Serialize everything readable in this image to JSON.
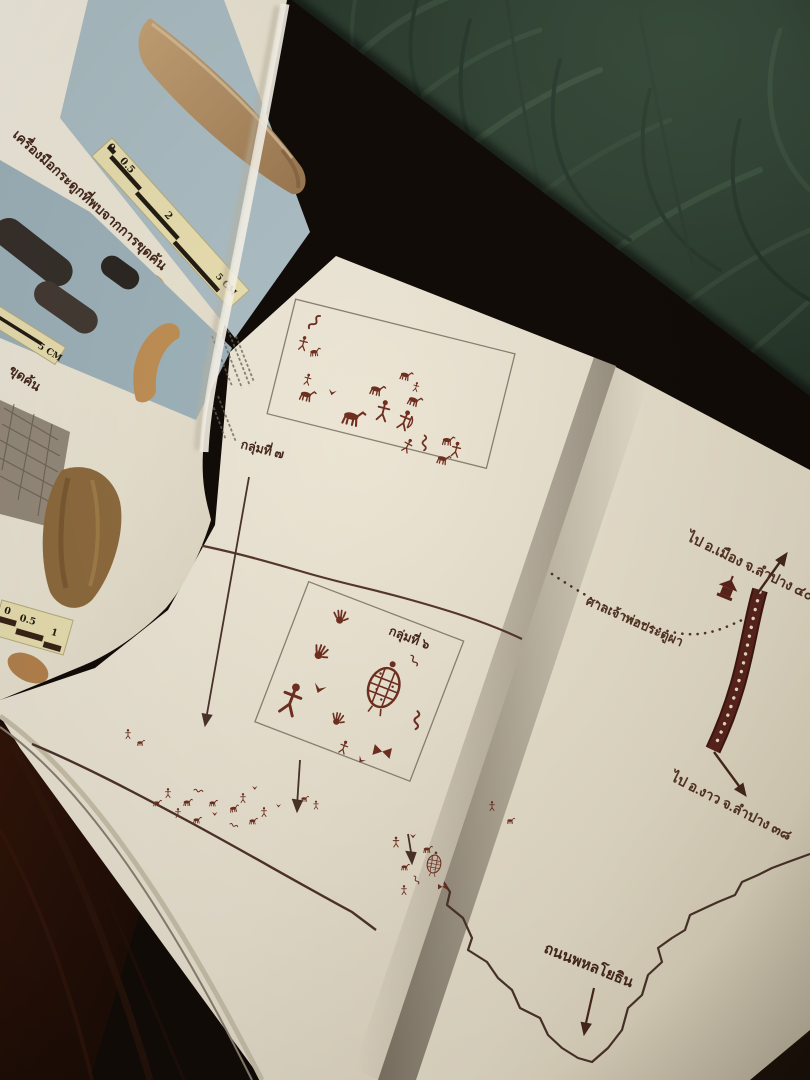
{
  "colors": {
    "wallpaper_green": "#2e4132",
    "wallpaper_emboss": "#3d5340",
    "shelf_wood": "#120c08",
    "shelf_wood_red": "#2d1309",
    "page_cream": "#ece5d4",
    "photo_blue_grey": "#a7bac1",
    "rock_art_maroon": "#6f2f20",
    "map_road_maroon": "#552218",
    "line_brown": "#55392b",
    "scale_cream": "#e9dfb0"
  },
  "left_page": {
    "caption_bone_tools": "เครื่องมือกระดูกที่พบจากการขุดค้น",
    "caption_partial": "ขุดค้น",
    "scale_bar_top": {
      "zero": "0",
      "half": "0.5",
      "two": "2",
      "five_cm": "5 CM"
    },
    "scale_bar_mid": {
      "five_cm": "5 CM"
    },
    "scale_bar_bottom": {
      "zero": "0",
      "half": "0.5",
      "one": "1"
    }
  },
  "center_page": {
    "group7_label": "กลุ่มที่ ๗",
    "group6_label": "กลุ่มที่ ๖"
  },
  "right_page": {
    "label_to_mueang": "ไป อ.เมือง จ.ลำปาง ๔๐",
    "label_shrine": "ศาลเจ้าพ่อประตูผา",
    "label_to_ngao": "ไป อ.งาว จ.ลำปาง ๓๘",
    "label_road": "ถนนพหลโยธิน"
  }
}
